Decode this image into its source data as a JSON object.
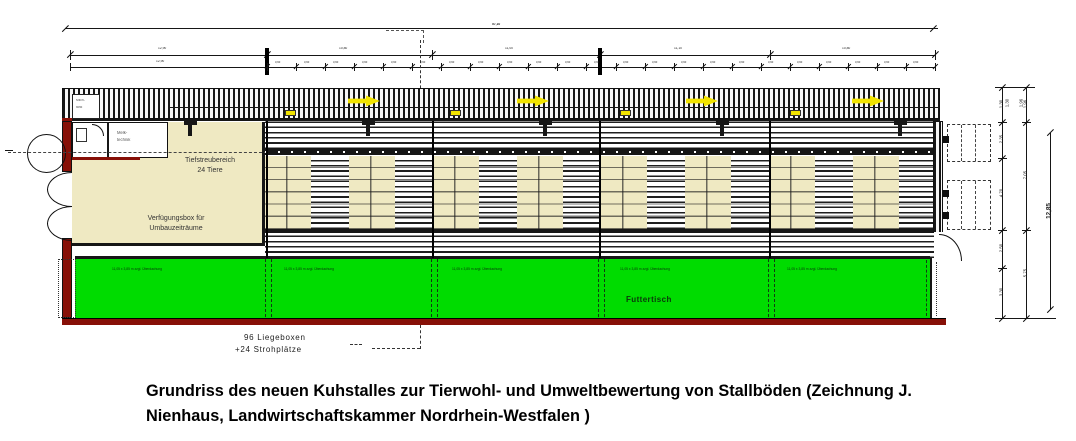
{
  "colors": {
    "cream": "#EFE9C2",
    "laufhof_green": "#00DC00",
    "wall_maroon": "#871007",
    "arrow_yellow": "#F2E400",
    "draw_line": "#161616"
  },
  "caption": {
    "line1": "Grundriss des neuen Kuhstalles zur Tierwohl- und Umweltbewertung von Stallböden (Zeichnung J.",
    "line2": "Nienhaus, Landwirtschaftskammer Nordrhein-Westfalen )"
  },
  "plan": {
    "deep_litter_area": {
      "line1": "Tiefstreubereich",
      "line2": "24 Tiere"
    },
    "flex_box": {
      "line1": "Verfügungsbox für",
      "line2": "Umbauzeiträume"
    },
    "feed_table_label": "Futtertisch",
    "cubicles_note": {
      "line1": "96 Liegeboxen",
      "line2": "+24 Strohplätze"
    },
    "service_room": {
      "line1": "Melk-",
      "line2": "technik"
    },
    "strip_box": {
      "line1": "Milch-",
      "line2": "tank"
    },
    "green_sections": [
      {
        "label": "11,05 x 3,85 m zzgl. Überdachung"
      },
      {
        "label": "11,05 x 3,85 m zzgl. Überdachung"
      },
      {
        "label": "11,05 x 3,85 m zzgl. Überdachung"
      },
      {
        "label": "11,05 x 3,85 m zzgl. Überdachung"
      },
      {
        "label": "11,05 x 3,85 m zzgl. Überdachung"
      }
    ],
    "feed_arrows": {
      "count": 4,
      "direction": "right"
    }
  },
  "dimensions": {
    "overall_top": "57,10",
    "row1": [
      "12,90",
      "10,80",
      "11,00",
      "11,10",
      "10,80"
    ],
    "row2_left": "12,90",
    "row2_step": "3,60",
    "right_top": [
      "1,30",
      "1,96"
    ],
    "right_chain1": [
      "2,35",
      "4,70",
      "2,50",
      "3,30"
    ],
    "right_chain2": [
      "7,05",
      "5,75"
    ],
    "right_overall": "12,85"
  }
}
